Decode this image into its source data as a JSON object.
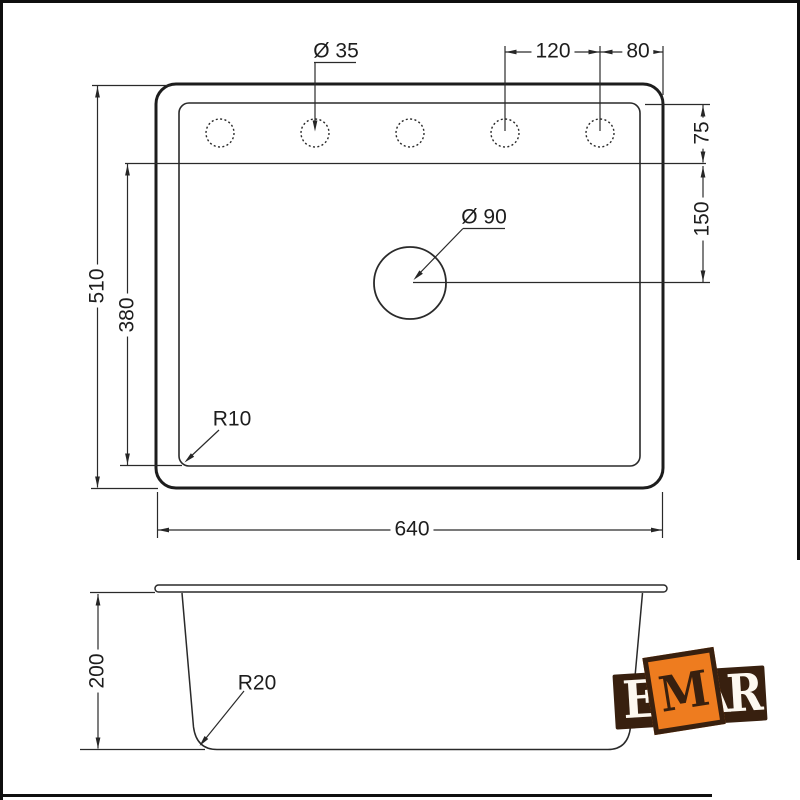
{
  "colors": {
    "line": "#262626",
    "frame": "#0f0f0f",
    "text": "#1d1d1d",
    "logo_brown": "#38200f",
    "logo_orange": "#ee7c1f",
    "logo_cream": "#fdf8f0"
  },
  "labels": {
    "height": "510",
    "inner_height": "380",
    "width": "640",
    "hole_spacing": "120",
    "edge_offset": "80",
    "deck_depth": "75",
    "drain_offset": "150",
    "hole_dia": "Ø 35",
    "drain_dia": "Ø 90",
    "corner_radius": "R10",
    "bowl_depth": "200",
    "bowl_radius": "R20"
  },
  "logo": {
    "e": "E",
    "m": "M",
    "a": "A",
    "r": "R"
  }
}
